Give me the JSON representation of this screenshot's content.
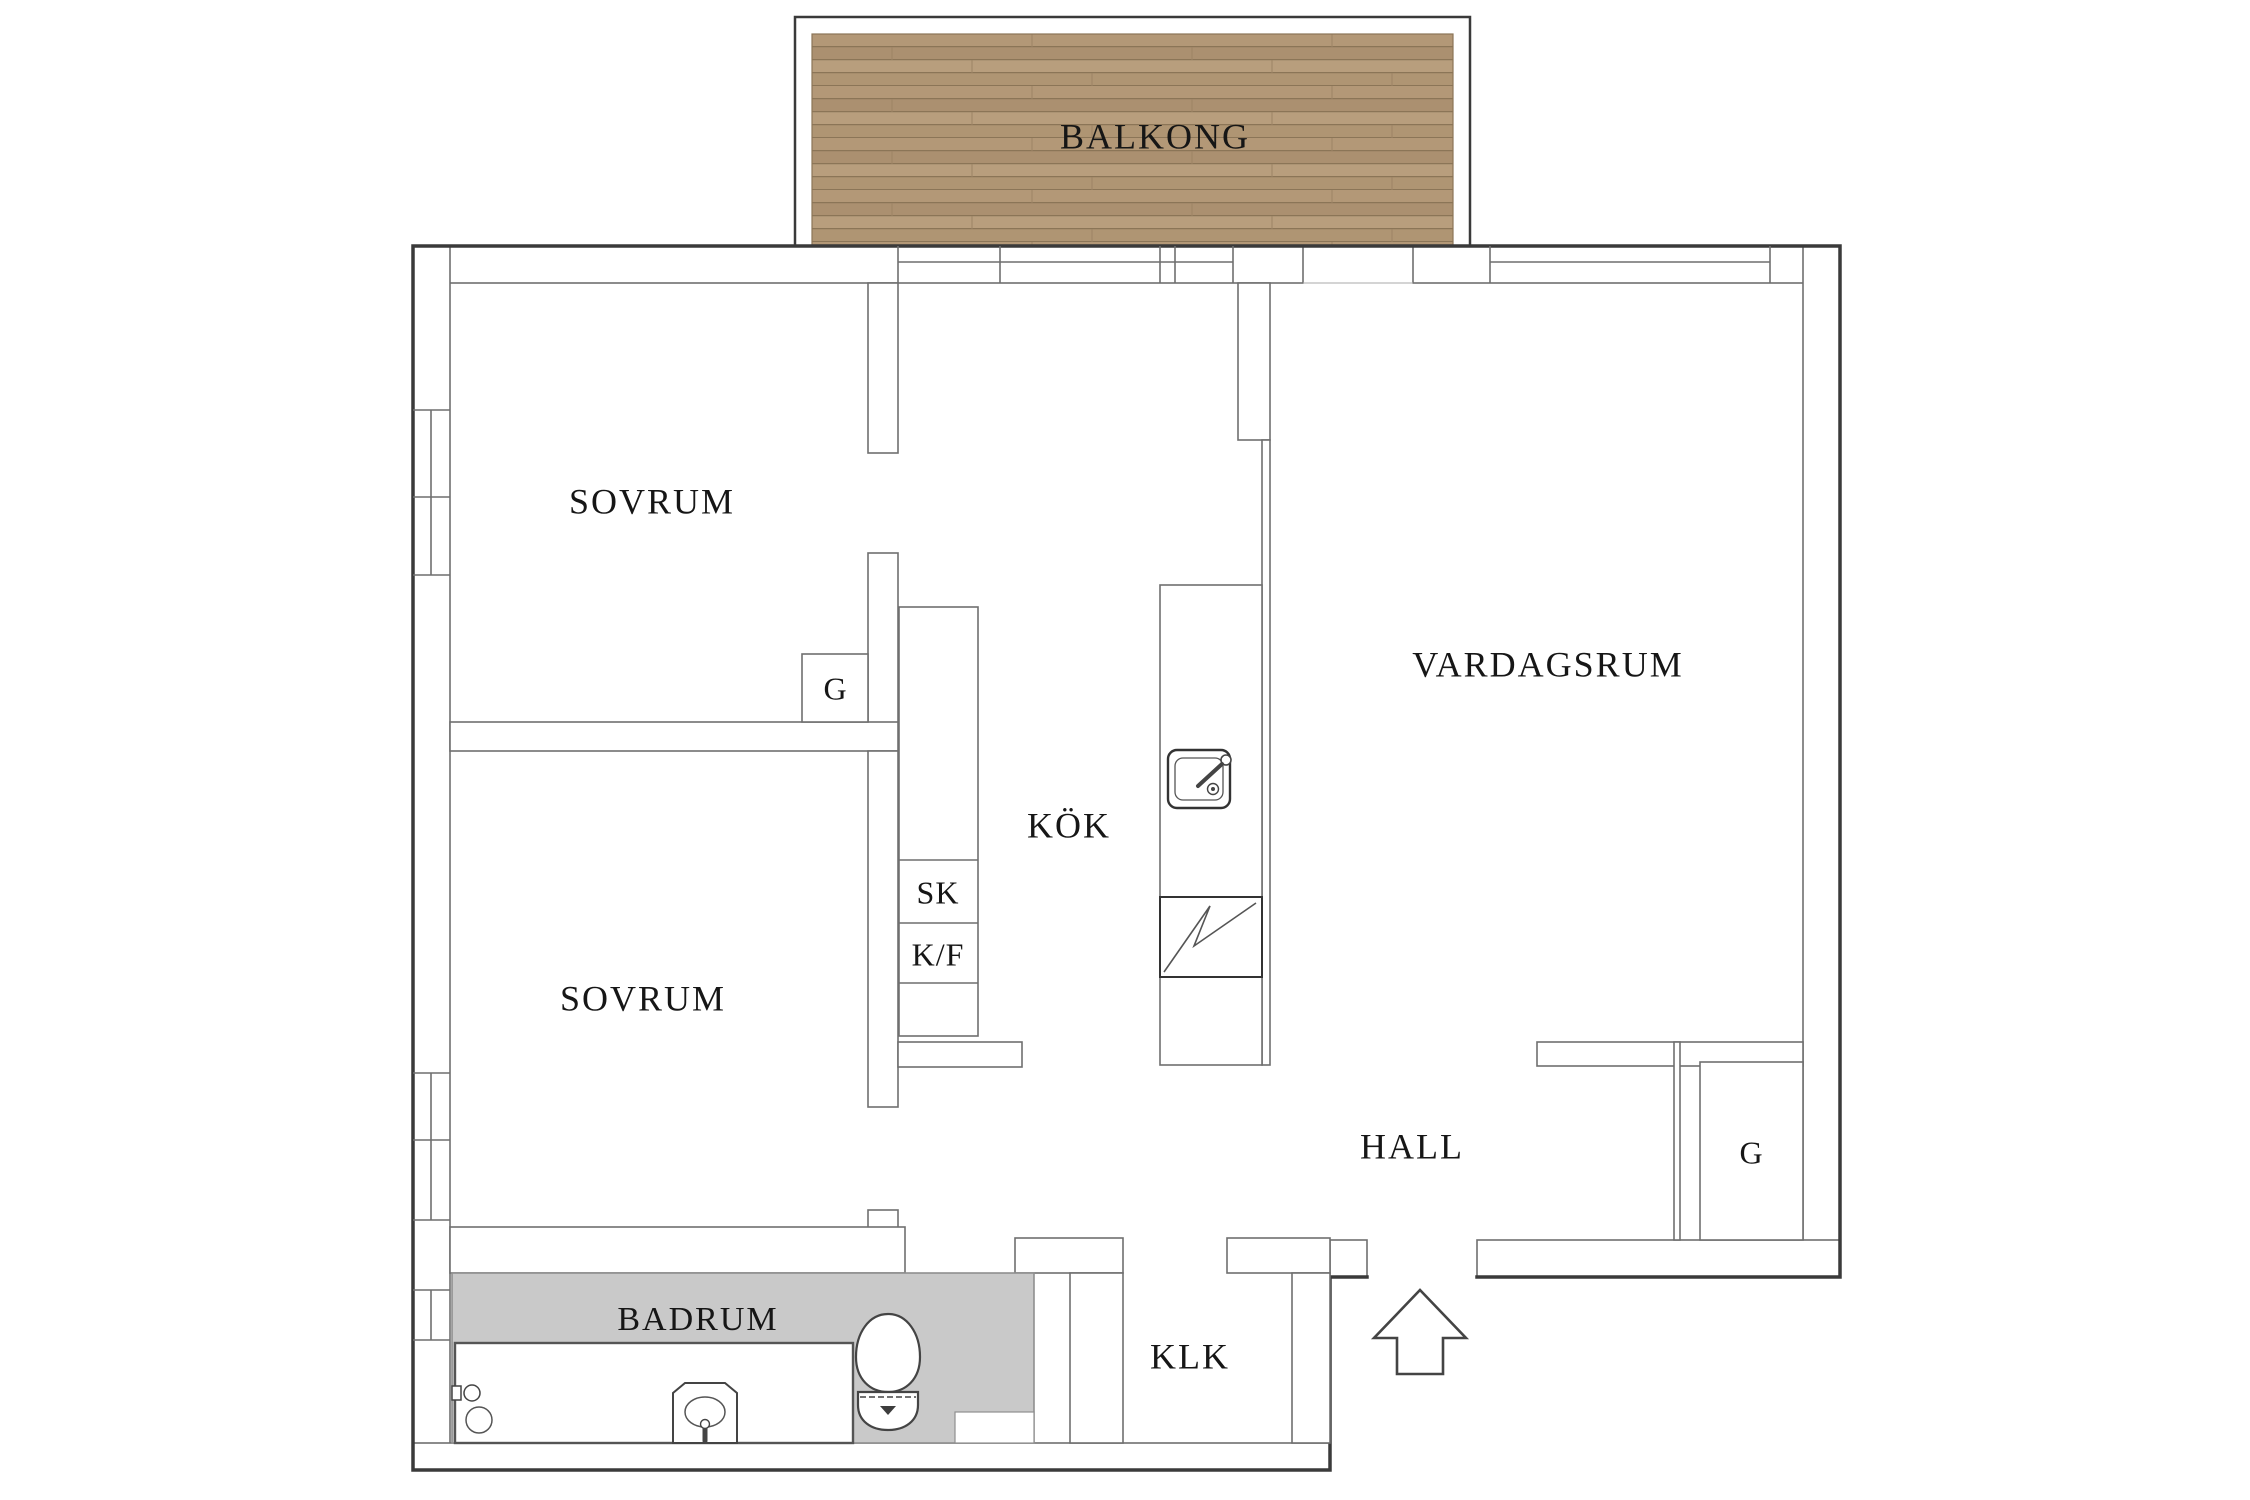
{
  "canvas": {
    "width": 2250,
    "height": 1500,
    "background": "#ffffff"
  },
  "colors": {
    "outer_wall": "#3a3a3a",
    "wall_line": "#6f6f6f",
    "fixture_line": "#4d4d4d",
    "text": "#161616",
    "bath_floor": "#c9c9c9",
    "bath_floor_line": "#8f8f8f",
    "deck_base": "#b39877",
    "deck_alt": "#ab9070",
    "deck_alt2": "#b89e7d",
    "deck_line": "#8b7557"
  },
  "labels": [
    {
      "id": "balkong",
      "text": "BALKONG",
      "x": 1155,
      "y": 140,
      "size": 36,
      "spacing": 2
    },
    {
      "id": "sovrum-1",
      "text": "SOVRUM",
      "x": 652,
      "y": 505,
      "size": 36,
      "spacing": 2
    },
    {
      "id": "sovrum-2",
      "text": "SOVRUM",
      "x": 643,
      "y": 1002,
      "size": 36,
      "spacing": 2
    },
    {
      "id": "vardagsrum",
      "text": "VARDAGSRUM",
      "x": 1548,
      "y": 668,
      "size": 36,
      "spacing": 2
    },
    {
      "id": "kok",
      "text": "KÖK",
      "x": 1069,
      "y": 829,
      "size": 36,
      "spacing": 2
    },
    {
      "id": "hall",
      "text": "HALL",
      "x": 1412,
      "y": 1150,
      "size": 36,
      "spacing": 2
    },
    {
      "id": "klk",
      "text": "KLK",
      "x": 1190,
      "y": 1360,
      "size": 36,
      "spacing": 2
    },
    {
      "id": "badrum",
      "text": "BADRUM",
      "x": 698,
      "y": 1322,
      "size": 34,
      "spacing": 2
    },
    {
      "id": "g-bedroom",
      "text": "G",
      "x": 835,
      "y": 692,
      "size": 32,
      "spacing": 0
    },
    {
      "id": "g-hall",
      "text": "G",
      "x": 1751,
      "y": 1156,
      "size": 32,
      "spacing": 0
    },
    {
      "id": "sk",
      "text": "SK",
      "x": 938,
      "y": 896,
      "size": 32,
      "spacing": 1
    },
    {
      "id": "kf",
      "text": "K/F",
      "x": 938,
      "y": 958,
      "size": 32,
      "spacing": 1
    }
  ],
  "fixtures": [
    "balcony-deck",
    "bathtub",
    "washbasin",
    "toilet",
    "kitchen-sink",
    "stove",
    "kitchen-cabinets",
    "kitchen-counter",
    "wardrobe-g-bedroom",
    "wardrobe-g-hall",
    "entry-arrow"
  ]
}
